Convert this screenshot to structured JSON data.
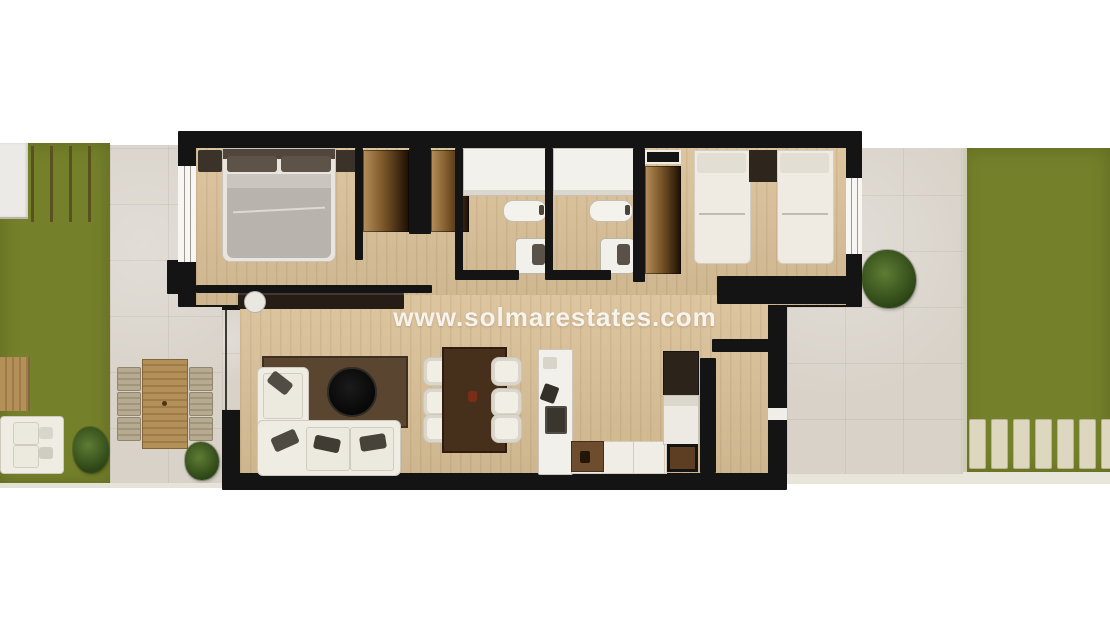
{
  "watermark": {
    "text": "www.solmarestates.com"
  },
  "palette": {
    "background": "#ffffff",
    "grass": "#75802b",
    "grass_stripe": "#59511f",
    "grass_edge": "#cfcbb4",
    "tile": "#d8d2c9",
    "tile_pale": "#e8e5da",
    "wood": "#d9c097",
    "wall": "#141414",
    "white_furniture": "#efece4",
    "duvet": "#b8b3ad",
    "rug": "#5a4530",
    "dining_table": "#46301c",
    "outdoor_wood": "#b08d58",
    "planter_white": "#eceae6",
    "watermark_white": "#ffffff"
  },
  "scene": {
    "type": "3d-rendered apartment floor plan, top-down view",
    "left_garden": {
      "name": "left garden",
      "objects": [
        "pergola-stripes",
        "white-planter",
        "wood-table",
        "outdoor-sofa",
        "plant"
      ]
    },
    "left_terrace": {
      "name": "left tiled terrace",
      "objects": [
        "outdoor-dining-table",
        "six-outdoor-chairs",
        "plant"
      ]
    },
    "apartment": {
      "rooms": [
        {
          "name": "master bedroom",
          "objects": [
            "double-bed",
            "nightstand",
            "nightstand",
            "window",
            "tv-console",
            "decor-disc"
          ]
        },
        {
          "name": "wardrobe hall",
          "objects": [
            "wardrobe",
            "wardrobe"
          ]
        },
        {
          "name": "bathroom 1",
          "objects": [
            "shower",
            "washbasin",
            "toilet"
          ]
        },
        {
          "name": "bathroom 2",
          "objects": [
            "shower",
            "washbasin",
            "toilet"
          ]
        },
        {
          "name": "bedroom 2",
          "objects": [
            "twin-bed",
            "twin-bed",
            "nightstand",
            "wardrobe",
            "shelf-box",
            "window"
          ]
        },
        {
          "name": "living room",
          "objects": [
            "corner-sofa",
            "rug",
            "round-coffee-table"
          ]
        },
        {
          "name": "dining area",
          "objects": [
            "dining-table",
            "six-chairs",
            "candle-decor"
          ]
        },
        {
          "name": "kitchen",
          "objects": [
            "island-counter",
            "hob",
            "faucet",
            "base-counter",
            "sink",
            "fridge",
            "tall-unit",
            "door-mat"
          ]
        },
        {
          "name": "entry hall",
          "objects": [
            "entry-door-opening"
          ]
        }
      ]
    },
    "right_terrace": {
      "name": "right tiled patio",
      "objects": [
        "plant"
      ]
    },
    "right_garden": {
      "name": "right garden",
      "objects": [
        "paving-slats"
      ]
    }
  }
}
